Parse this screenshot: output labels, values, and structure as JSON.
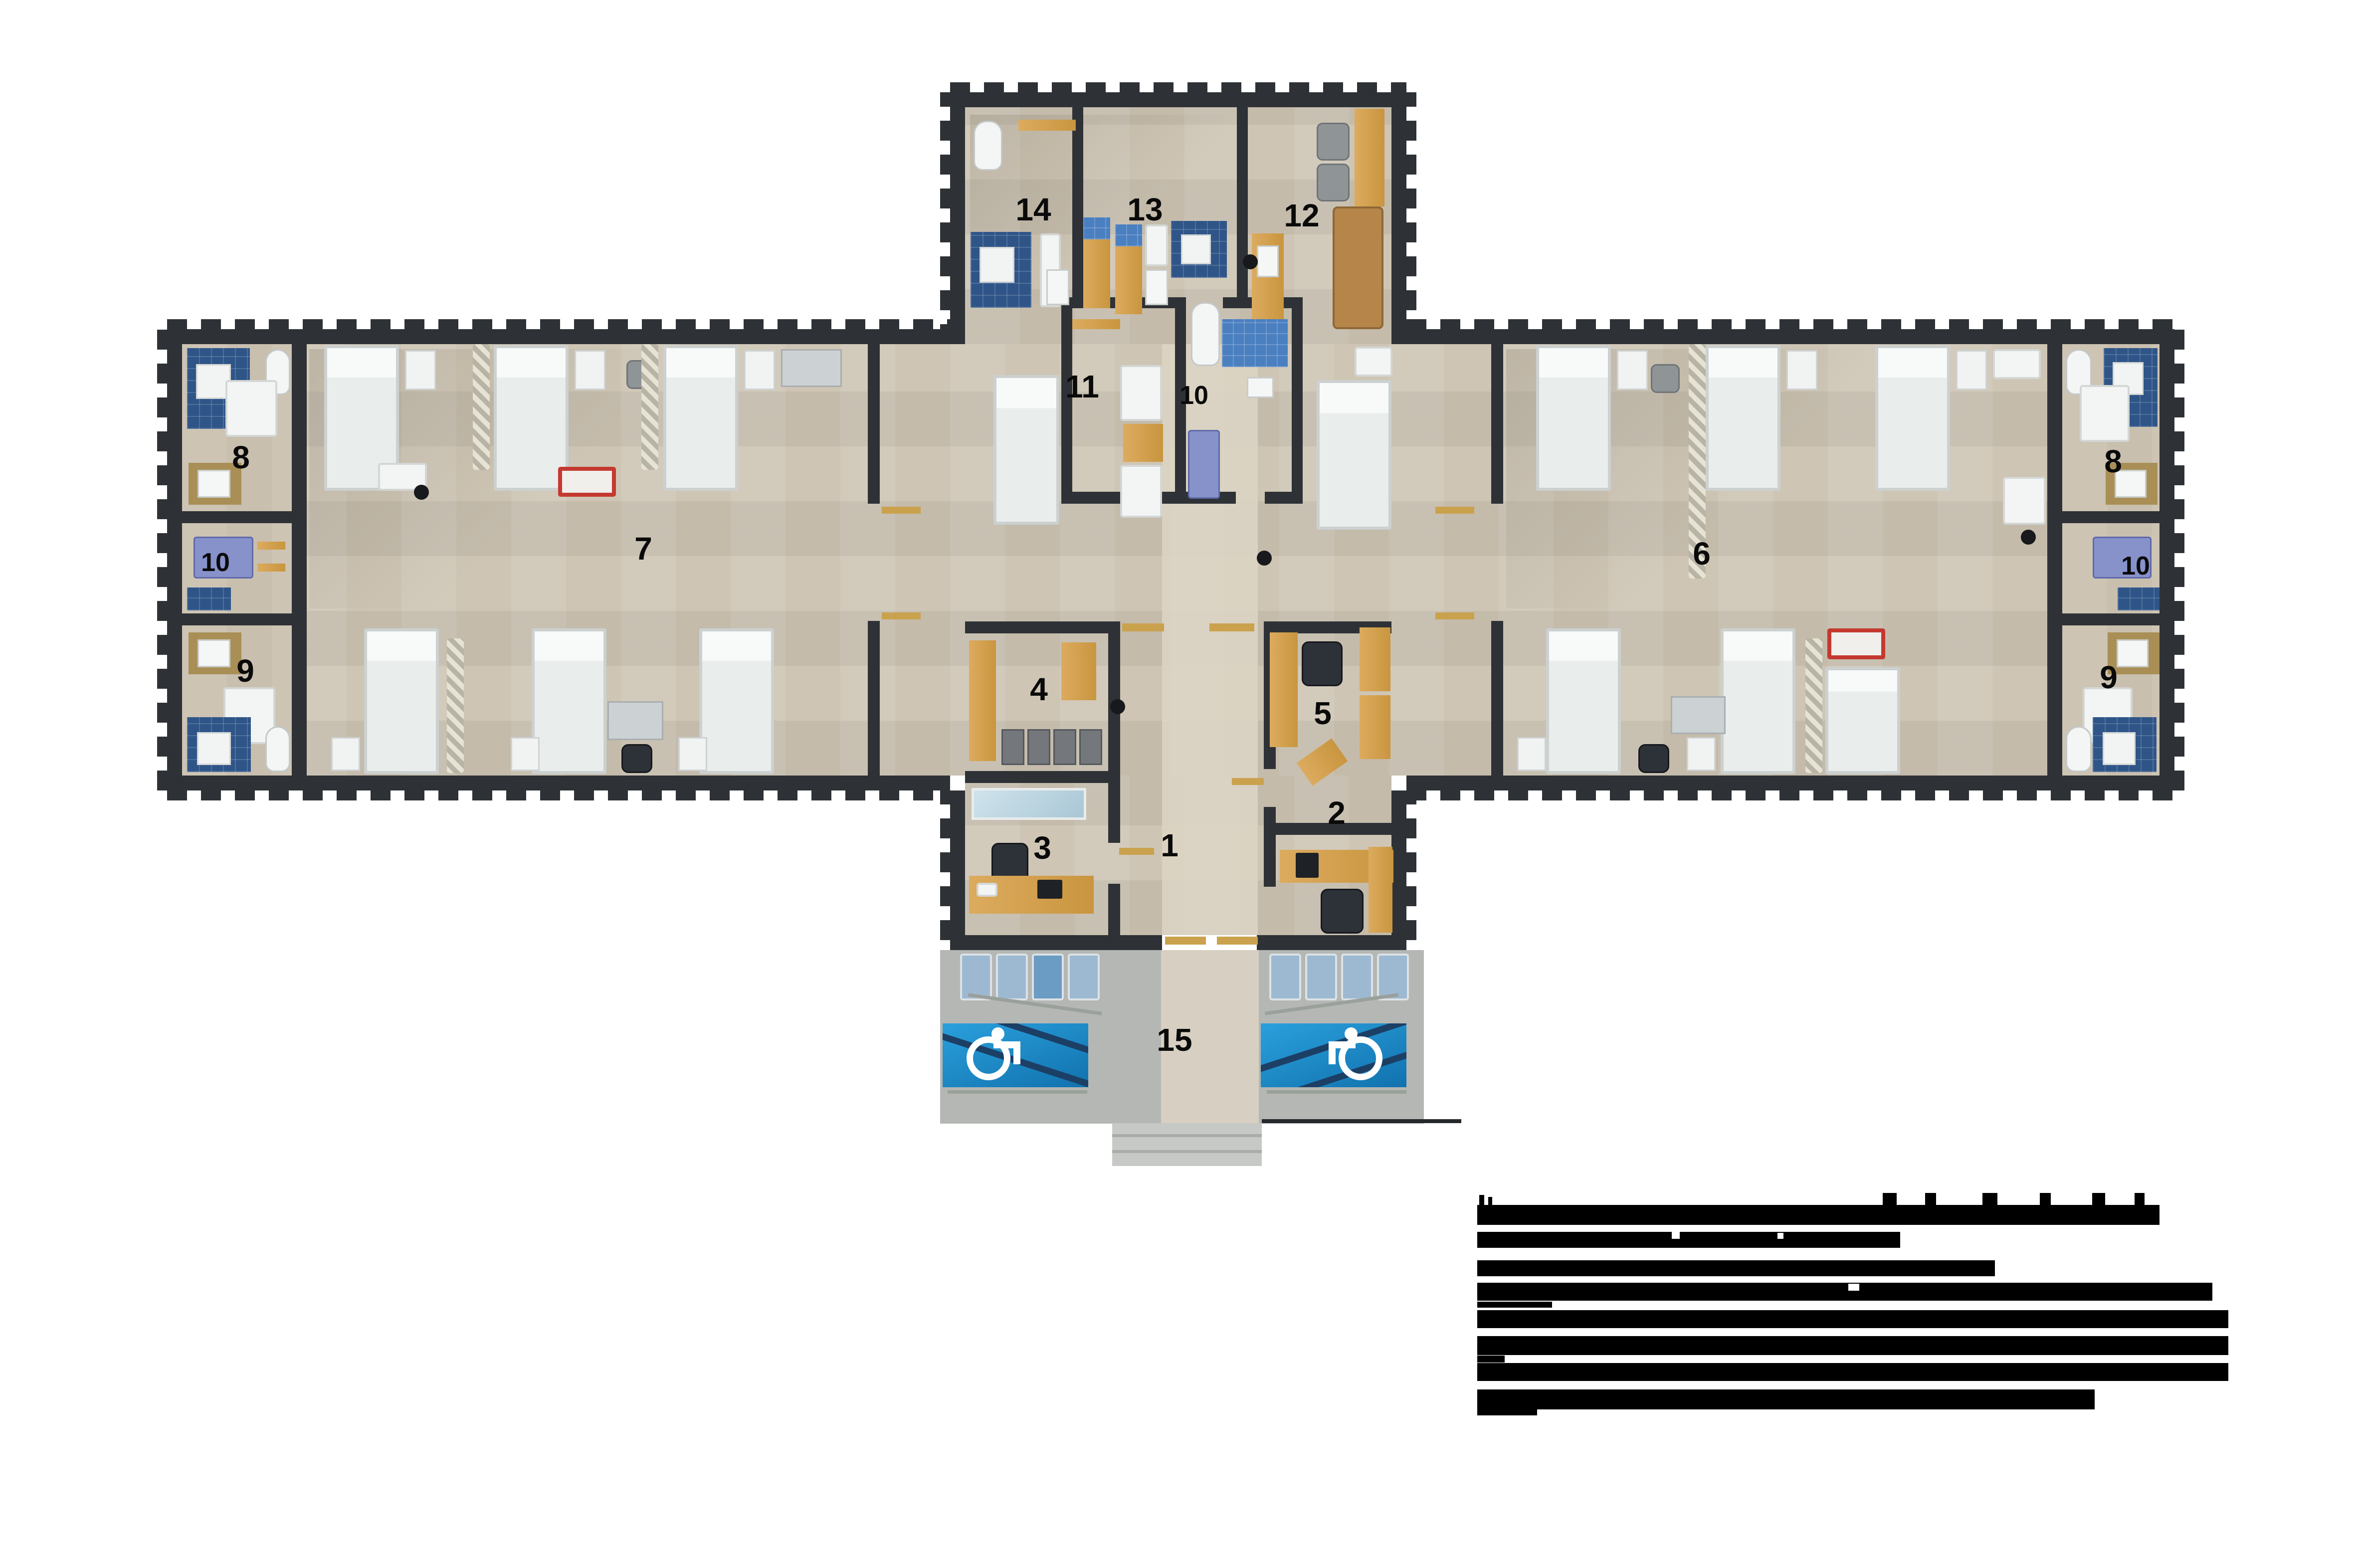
{
  "plan": {
    "type": "architectural-floor-plan",
    "shape": "cross",
    "labels": {
      "n1": "1",
      "n2": "2",
      "n3": "3",
      "n4": "4",
      "n5": "5",
      "n6": "6",
      "n7": "7",
      "n8L": "8",
      "n8R": "8",
      "n9L": "9",
      "n9R": "9",
      "n10L": "10",
      "n10C": "10",
      "n10R": "10",
      "n11": "11",
      "n12": "12",
      "n13": "13",
      "n14": "14",
      "n15": "15"
    },
    "colors": {
      "wall": "#2e3236",
      "floor": "#cec5b4",
      "tile_blue_dark": "#2f5588",
      "tile_blue_mid": "#4a7fc0",
      "handicap_blue": "#1f93d1",
      "wood": "#dcab5e",
      "bed_white": "#e9edec",
      "cart_red": "#c4392f",
      "porch_concrete": "#b4b7b4",
      "porch_chair_blue": "#9db9d2",
      "redaction": "#000000"
    }
  },
  "legend": {
    "redacted": true,
    "visible_text": "",
    "rows": 8
  },
  "icons": {
    "wheelchair_left": "wheelchair-symbol",
    "wheelchair_right": "wheelchair-symbol"
  }
}
